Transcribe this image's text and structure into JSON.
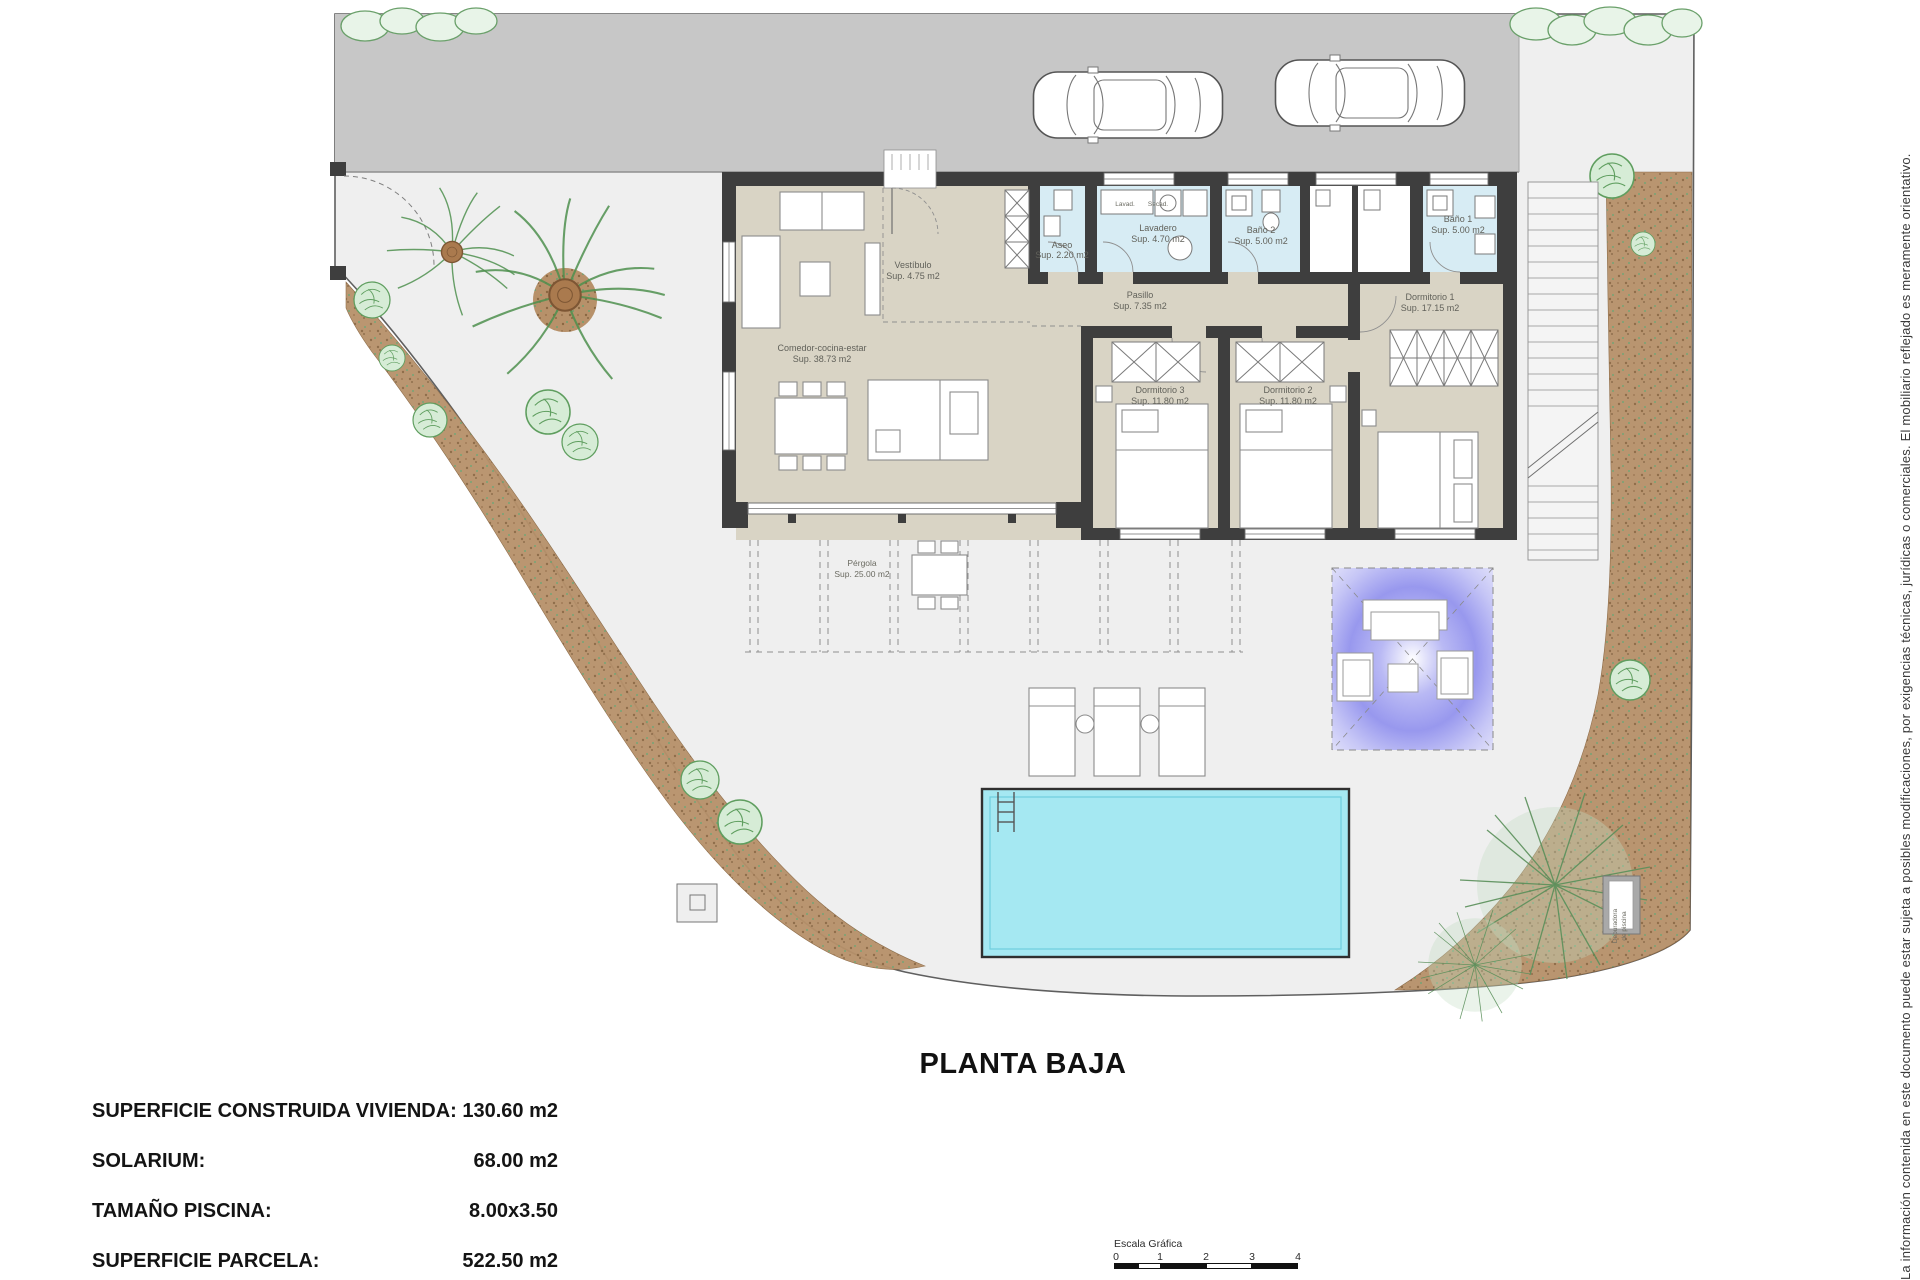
{
  "plan_title": "PLANTA BAJA",
  "rooms": {
    "comedor": {
      "name": "Comedor-cocina-estar",
      "area": "Sup. 38.73 m2"
    },
    "vestibulo": {
      "name": "Vestíbulo",
      "area": "Sup. 4.75 m2"
    },
    "aseo": {
      "name": "Aseo",
      "area": "Sup. 2.20 m2"
    },
    "lavadero": {
      "name": "Lavadero",
      "area": "Sup. 4.70 m2"
    },
    "bano2": {
      "name": "Baño 2",
      "area": "Sup. 5.00 m2"
    },
    "bano1": {
      "name": "Baño 1",
      "area": "Sup. 5.00 m2"
    },
    "pasillo": {
      "name": "Pasillo",
      "area": "Sup. 7.35 m2"
    },
    "dorm3": {
      "name": "Dormitorio 3",
      "area": "Sup. 11.80 m2"
    },
    "dorm2": {
      "name": "Dormitorio 2",
      "area": "Sup. 11.80 m2"
    },
    "dorm1": {
      "name": "Dormitorio 1",
      "area": "Sup. 17.15 m2"
    },
    "pergola": {
      "name": "Pérgola",
      "area": "Sup. 25.00 m2"
    }
  },
  "laundry": {
    "washer": "Lavad.",
    "dryer": "Secad."
  },
  "equipment": {
    "pool_pump_line1": "Depuradora",
    "pool_pump_line2": "de piscina"
  },
  "summary": {
    "rows": [
      {
        "label": "SUPERFICIE CONSTRUIDA VIVIENDA:",
        "value": "130.60 m2"
      },
      {
        "label": "SOLARIUM:",
        "value": "68.00 m2"
      },
      {
        "label": "TAMAÑO PISCINA:",
        "value": "8.00x3.50"
      },
      {
        "label": "SUPERFICIE PARCELA:",
        "value": "522.50 m2"
      }
    ]
  },
  "scale_bar": {
    "title": "Escala Gráfica",
    "ticks": [
      "0",
      "1",
      "2",
      "3",
      "4"
    ]
  },
  "disclaimer": "La información contenida en este documento puede estar sujeta a posibles modificaciones, por exigencias técnicas, jurídicas o comerciales. El mobiliario reflejado es meramente orientativo.",
  "colors": {
    "driveway": "#c7c7c7",
    "floor": "#d9d4c5",
    "wet_rooms": "#d7ecf4",
    "walls": "#3e3e3e",
    "pool": "#a5e8f2",
    "garden_path": "#b7916a",
    "pergola_glow": "#9898ee",
    "plot": "#efefef"
  }
}
